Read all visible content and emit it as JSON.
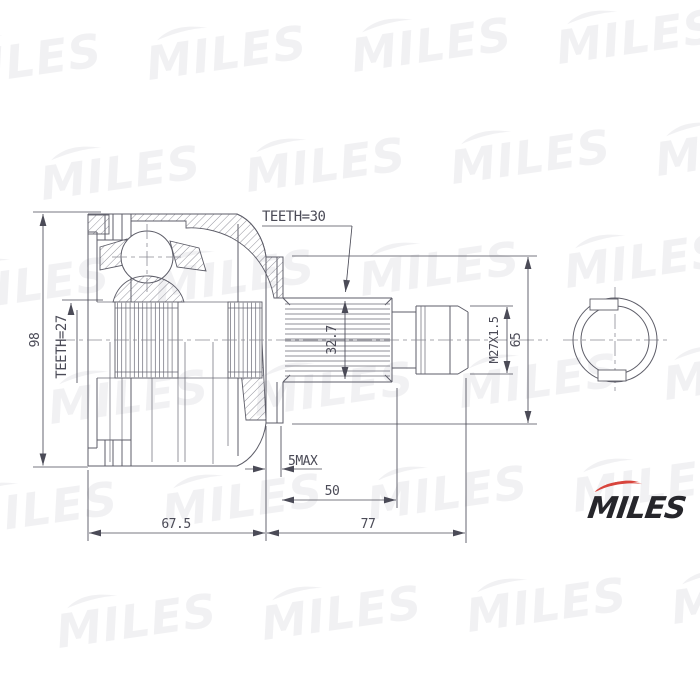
{
  "drawing": {
    "labels": {
      "teeth30": "TEETH=30",
      "teeth27": "TEETH=27",
      "d98": "98",
      "d327": "32.7",
      "thread": "M27X1.5",
      "d65": "65",
      "smax": "5MAX",
      "d50": "50",
      "d675": "67.5",
      "d77": "77"
    }
  },
  "watermark": {
    "text": "MILES"
  },
  "logo": {
    "text": "MILES",
    "accent_color": "#d8453d",
    "ink_color": "#26262b"
  },
  "colors": {
    "line": "#5d5d68",
    "dimension": "#4b4b57",
    "background": "#ffffff"
  }
}
